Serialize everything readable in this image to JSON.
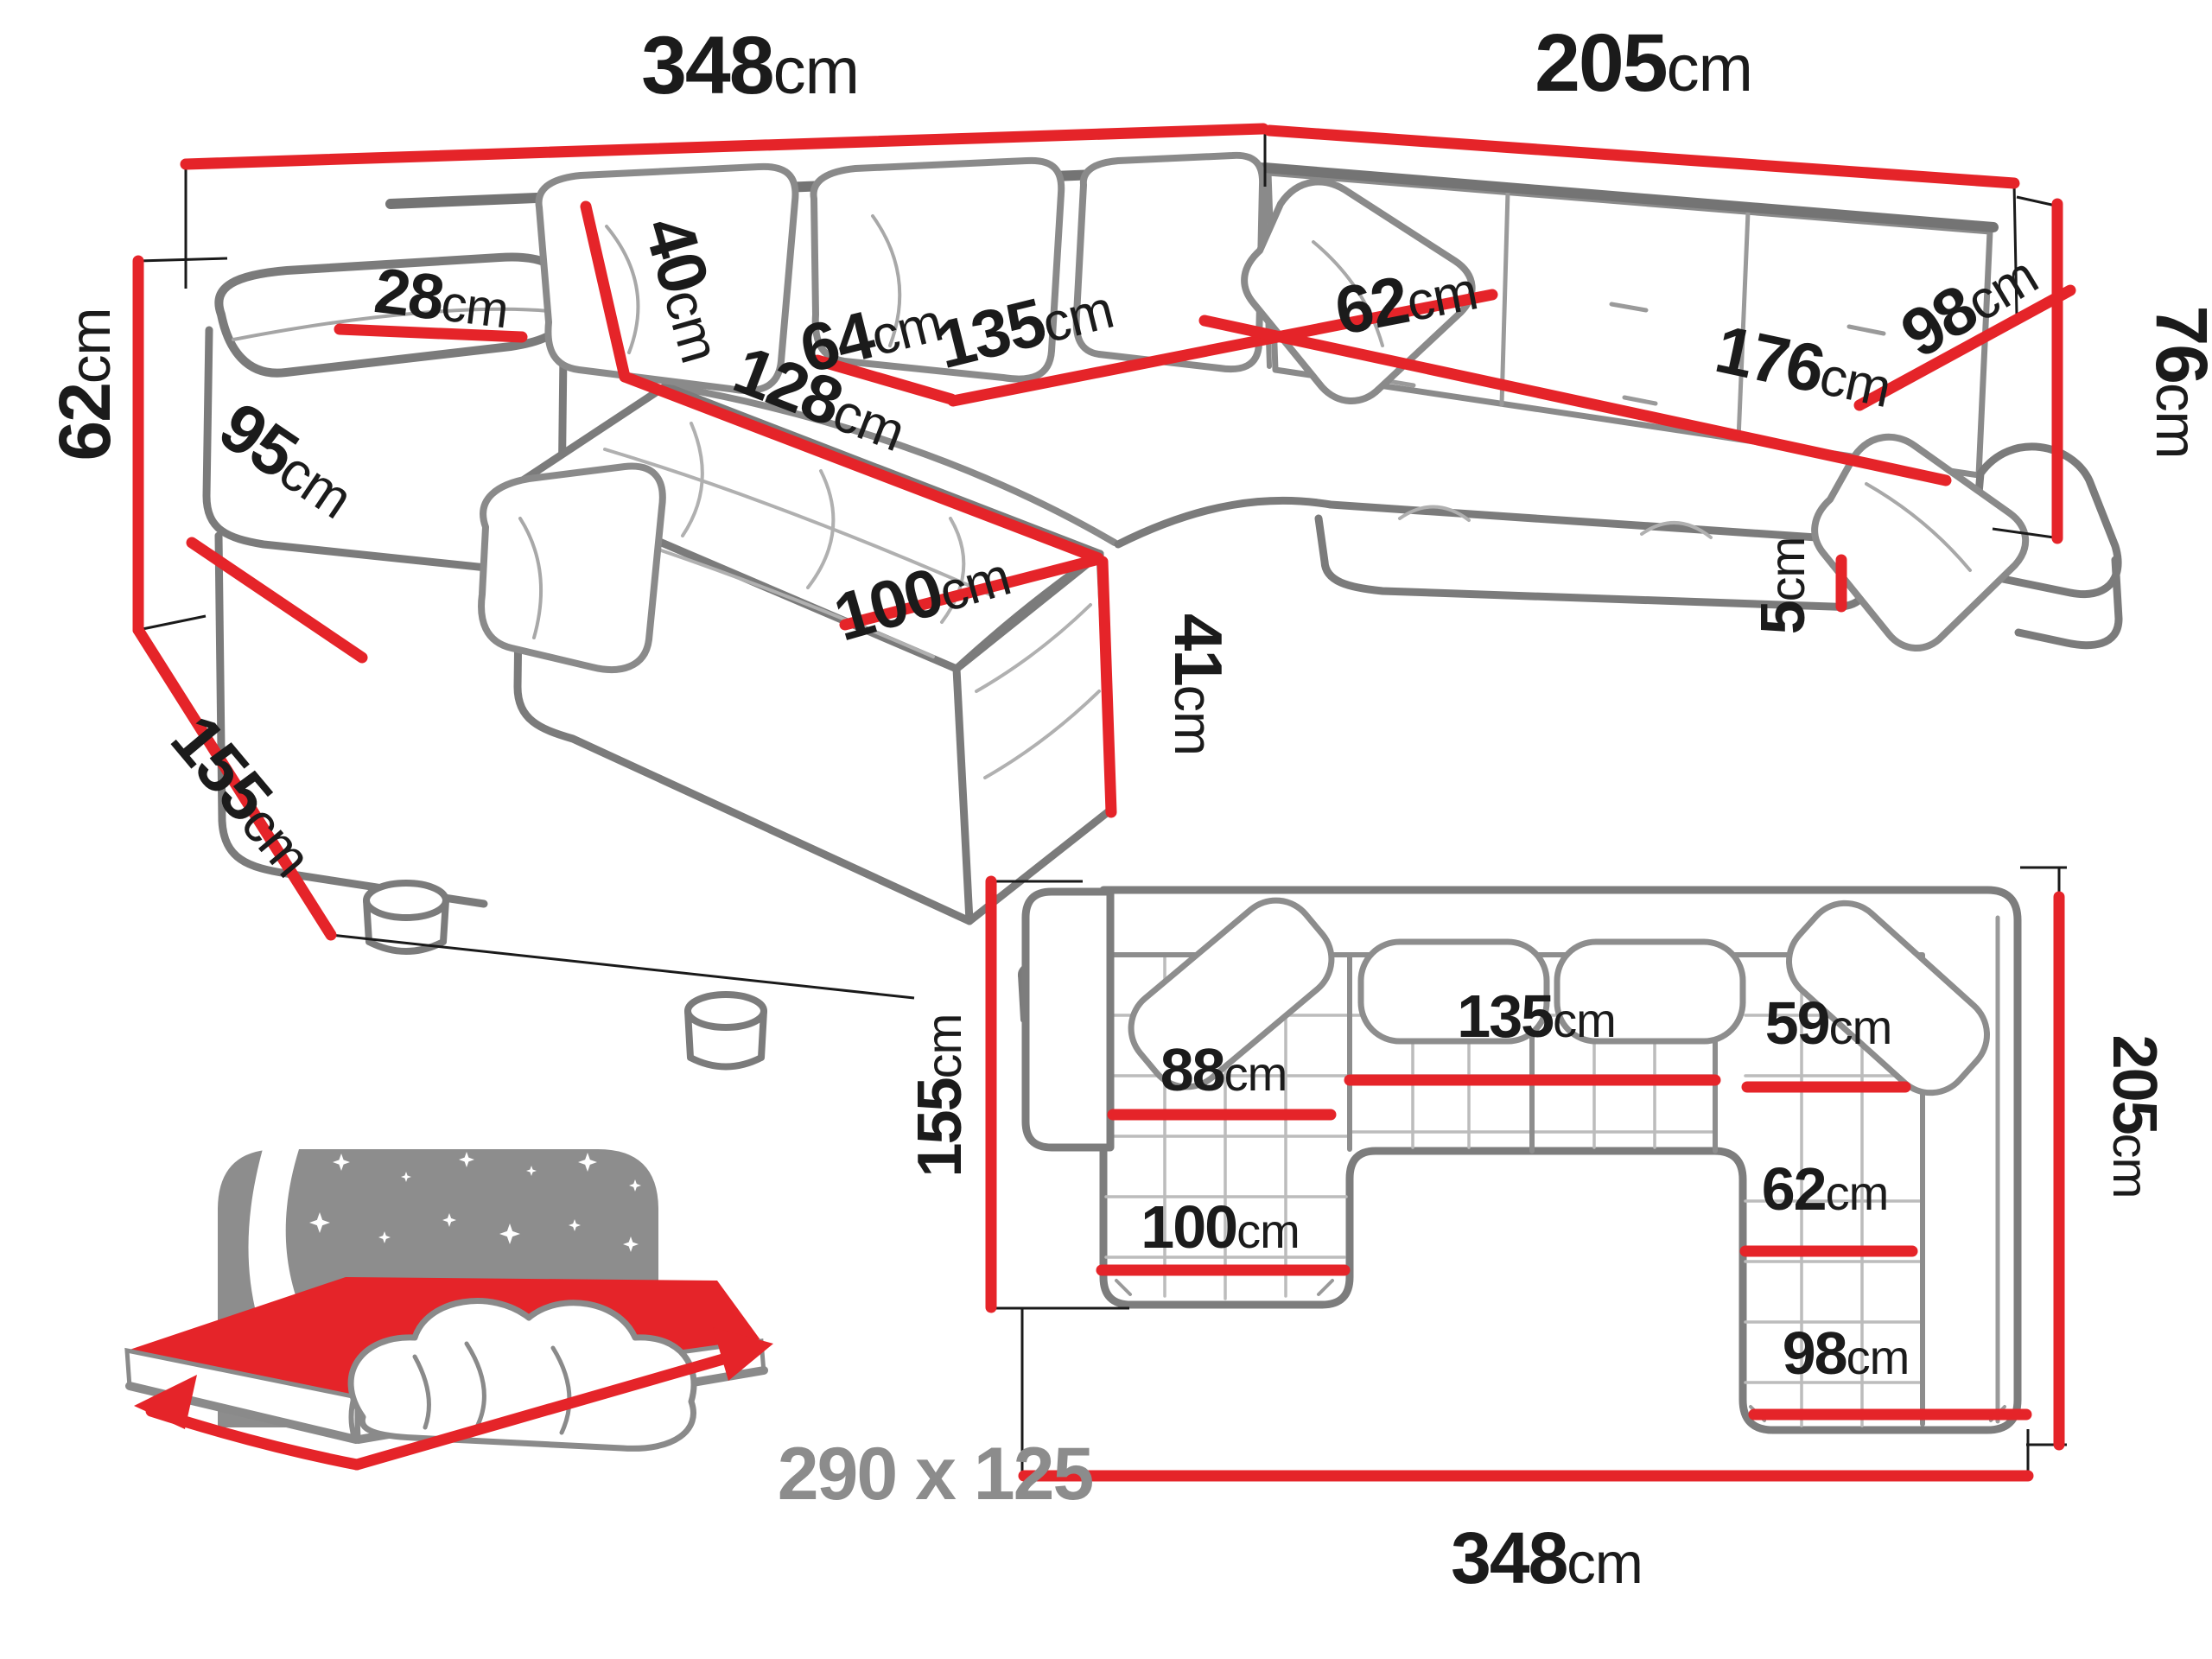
{
  "colors": {
    "dimension_red": "#e52429",
    "sofa_outline_gray": "#7b7b7b",
    "sofa_detail_gray": "#a8a8a8",
    "label_black": "#1b1b1b",
    "icon_gray": "#8d8d8d"
  },
  "perspective": {
    "w348": {
      "v": "348",
      "u": "cm"
    },
    "w205": {
      "v": "205",
      "u": "cm"
    },
    "h62": {
      "v": "62",
      "u": "cm"
    },
    "h76": {
      "v": "76",
      "u": "cm"
    },
    "arm95": {
      "v": "95",
      "u": "cm"
    },
    "d155": {
      "v": "155",
      "u": "cm"
    },
    "arm28": {
      "v": "28",
      "u": "cm"
    },
    "c40": {
      "v": "40",
      "u": "cm"
    },
    "s64": {
      "v": "64",
      "u": "cm"
    },
    "s135": {
      "v": "135",
      "u": "cm"
    },
    "ch128": {
      "v": "128",
      "u": "cm"
    },
    "ch100": {
      "v": "100",
      "u": "cm"
    },
    "sh41": {
      "v": "41",
      "u": "cm"
    },
    "s62": {
      "v": "62",
      "u": "cm"
    },
    "s176": {
      "v": "176",
      "u": "cm"
    },
    "s98": {
      "v": "98",
      "u": "cm"
    },
    "leg5": {
      "v": "5",
      "u": "cm"
    }
  },
  "plan": {
    "d155": {
      "v": "155",
      "u": "cm"
    },
    "d205": {
      "v": "205",
      "u": "cm"
    },
    "w348": {
      "v": "348",
      "u": "cm"
    },
    "c88": {
      "v": "88",
      "u": "cm"
    },
    "m135": {
      "v": "135",
      "u": "cm"
    },
    "r59": {
      "v": "59",
      "u": "cm"
    },
    "c100": {
      "v": "100",
      "u": "cm"
    },
    "r62": {
      "v": "62",
      "u": "cm"
    },
    "r98": {
      "v": "98",
      "u": "cm"
    }
  },
  "sleeping": {
    "size": "290 x 125"
  }
}
